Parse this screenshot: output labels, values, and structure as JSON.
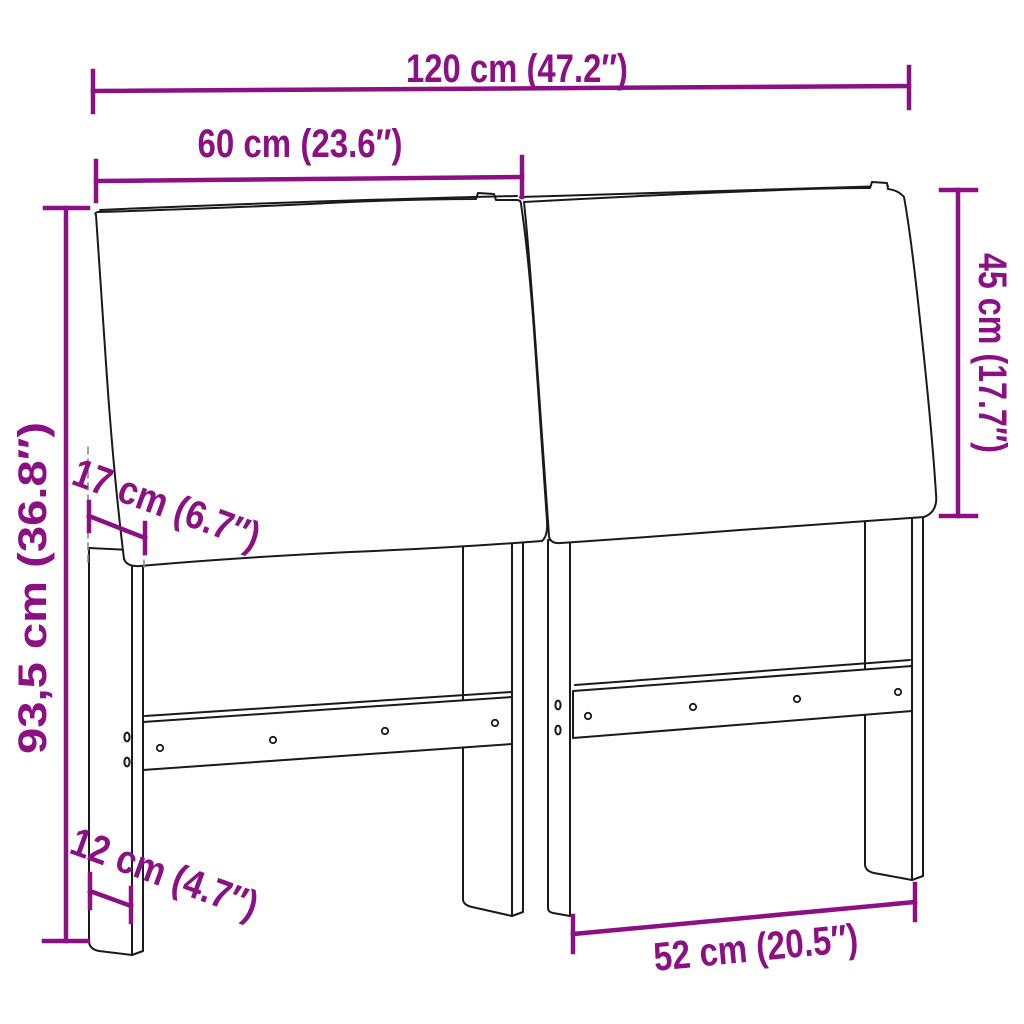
{
  "diagram": {
    "type": "furniture-dimension-drawing",
    "subject": "headboard-with-cushions",
    "dims": {
      "total_width": "120 cm (47.2″)",
      "half_width": "60 cm (23.6″)",
      "total_height": "93,5 cm (36.8″)",
      "cushion_height": "45 cm (17.7″)",
      "cushion_depth": "17 cm (6.7″)",
      "leg_depth": "12 cm (4.7″)",
      "leg_spacing": "52 cm (20.5″)"
    },
    "colors": {
      "dimension_accent": "#8A1083",
      "line_art": "#1A1A1A",
      "hidden_edge": "#8A8A8A",
      "background": "#FFFFFF"
    }
  }
}
